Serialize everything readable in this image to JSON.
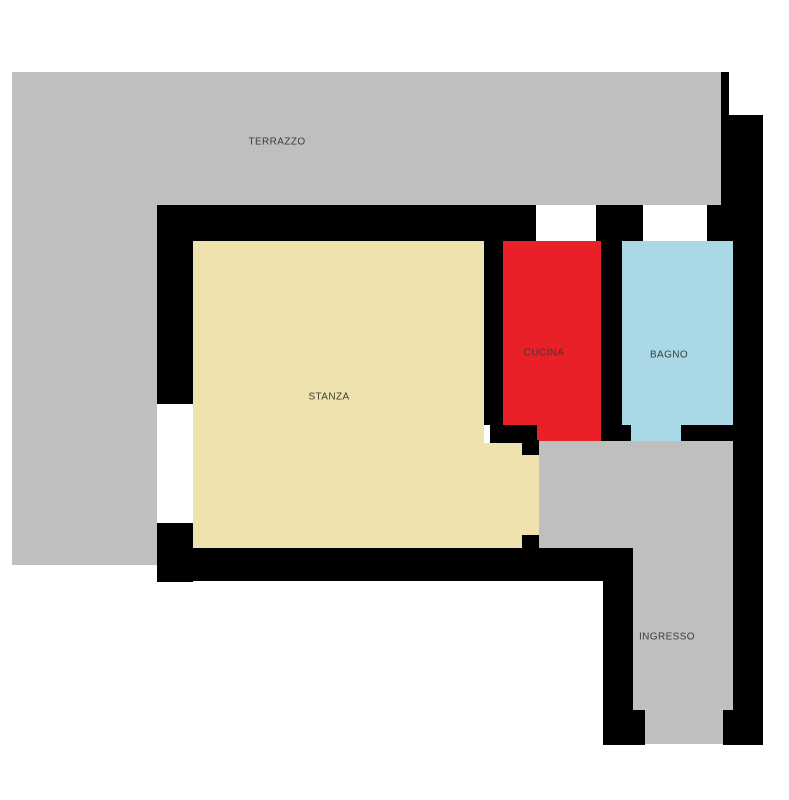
{
  "floorplan": {
    "background_color": "#ffffff",
    "wall_color": "#000000",
    "label_color": "#3c3c3c",
    "rooms": [
      {
        "id": "terrazzo",
        "label": "TERRAZZO",
        "color": "#bfbfbf"
      },
      {
        "id": "stanza",
        "label": "STANZA",
        "color": "#eee3ae"
      },
      {
        "id": "cucina",
        "label": "CUCINA",
        "color": "#e92028"
      },
      {
        "id": "bagno",
        "label": "BAGNO",
        "color": "#a9d9e6"
      },
      {
        "id": "ingresso",
        "label": "INGRESSO",
        "color": "#bfbfbf"
      }
    ]
  }
}
